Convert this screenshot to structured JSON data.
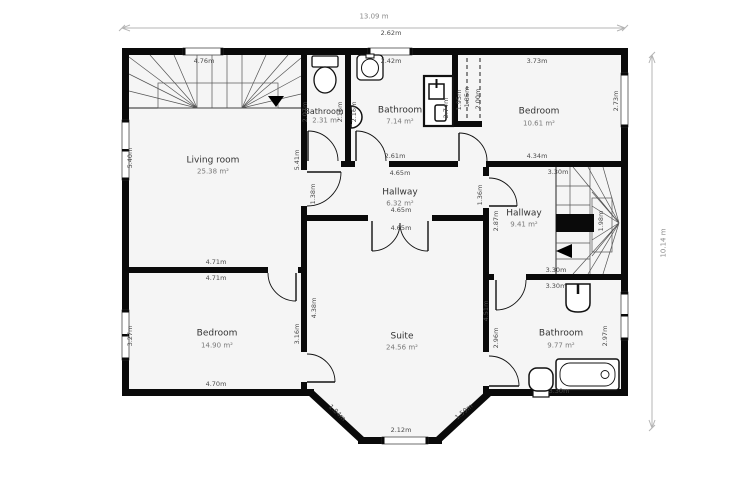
{
  "overall": {
    "width_label": "13.09 m",
    "height_label": "10.14 m"
  },
  "rooms": {
    "living_room": {
      "name": "Living room",
      "area": "25.38 m²"
    },
    "bathroom_small": {
      "name": "Bathroom",
      "area": "2.31 m²"
    },
    "bathroom_top": {
      "name": "Bathroom",
      "area": "7.14 m²"
    },
    "bedroom_top": {
      "name": "Bedroom",
      "area": "10.61 m²"
    },
    "hallway_center": {
      "name": "Hallway",
      "area": "6.32 m²"
    },
    "hallway_right": {
      "name": "Hallway",
      "area": "9.41 m²"
    },
    "bedroom_left": {
      "name": "Bedroom",
      "area": "14.90 m²"
    },
    "suite": {
      "name": "Suite",
      "area": "24.56 m²"
    },
    "bathroom_right": {
      "name": "Bathroom",
      "area": "9.77 m²"
    }
  },
  "measurements": {
    "stairs_top_width": "4.76m",
    "bath_window_outer": "2.62m",
    "bath_window_inner": "2.42m",
    "bedroom_top_width": "3.73m",
    "bedroom_top_bottom": "4.34m",
    "bedroom_top_right": "2.73m",
    "bath_top_bottom": "2.61m",
    "hallway_top": "4.65m",
    "hallway_bottom": "4.65m",
    "suite_top": "4.65m",
    "hallway_left": "1.38m",
    "hallway_right": "1.36m",
    "hallway2_left": "2.87m",
    "hallway2_top": "3.30m",
    "hallway2_bottom": "3.30m",
    "bathroom3_top": "3.30m",
    "bathroom3_bottom": "3.30m",
    "stairs_right_width": "1.98m",
    "living_left": "5.40m",
    "living_right": "5.41m",
    "wall_mid_top": "4.71m",
    "wall_mid_bottom": "4.71m",
    "bedroom2_left": "3.27m",
    "bedroom2_right": "3.16m",
    "bedroom2_bottom": "4.70m",
    "suite_left": "4.38m",
    "suite_right": "4.51m",
    "bathroom3_left": "2.96m",
    "bathroom3_right": "2.97m",
    "bay_left": "1.84m",
    "bay_bottom": "2.12m",
    "bay_right": "1.59m",
    "shower_height": "2.74m",
    "closet_a": "1.95m",
    "closet_b": "1.85m",
    "closet_c": "2.00m",
    "smallbath_left": "2.07m",
    "smallbath_right": "2.16m",
    "bath_top_left": "2.16m"
  }
}
